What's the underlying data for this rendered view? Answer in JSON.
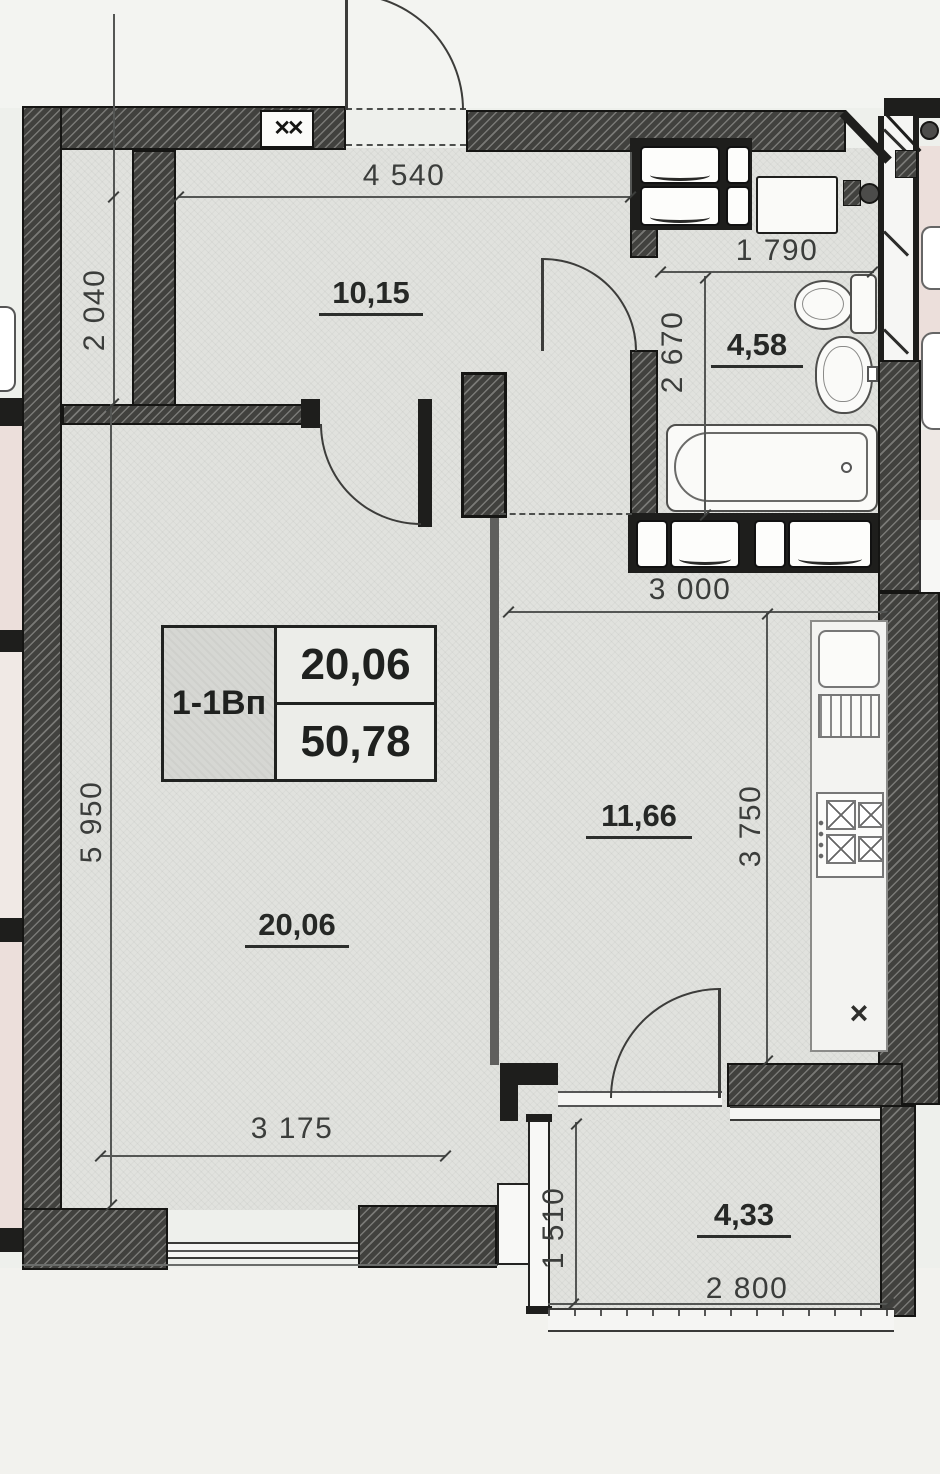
{
  "plan": {
    "unit_box": {
      "code": "1-1Вп",
      "upper": "20,06",
      "lower": "50,78"
    },
    "rooms": {
      "hall": "10,15",
      "bathroom": "4,58",
      "living": "20,06",
      "kitchen": "11,66",
      "balcony": "4,33"
    },
    "dims": {
      "top_width": "4 540",
      "hall_depth": "2 040",
      "bath_width": "1 790",
      "bath_depth": "2 670",
      "kitchen_width": "3 000",
      "living_depth": "5 950",
      "kitchen_depth": "3 750",
      "living_width": "3 175",
      "balcony_depth": "1 510",
      "balcony_width": "2 800"
    },
    "symbols": {
      "counter_end": "×",
      "window_brace": "✕✕"
    },
    "colors": {
      "wall": "#41413e",
      "line": "#545654",
      "floor": "#e1e2de",
      "neighbor_floor": "#ecdfdb"
    }
  }
}
